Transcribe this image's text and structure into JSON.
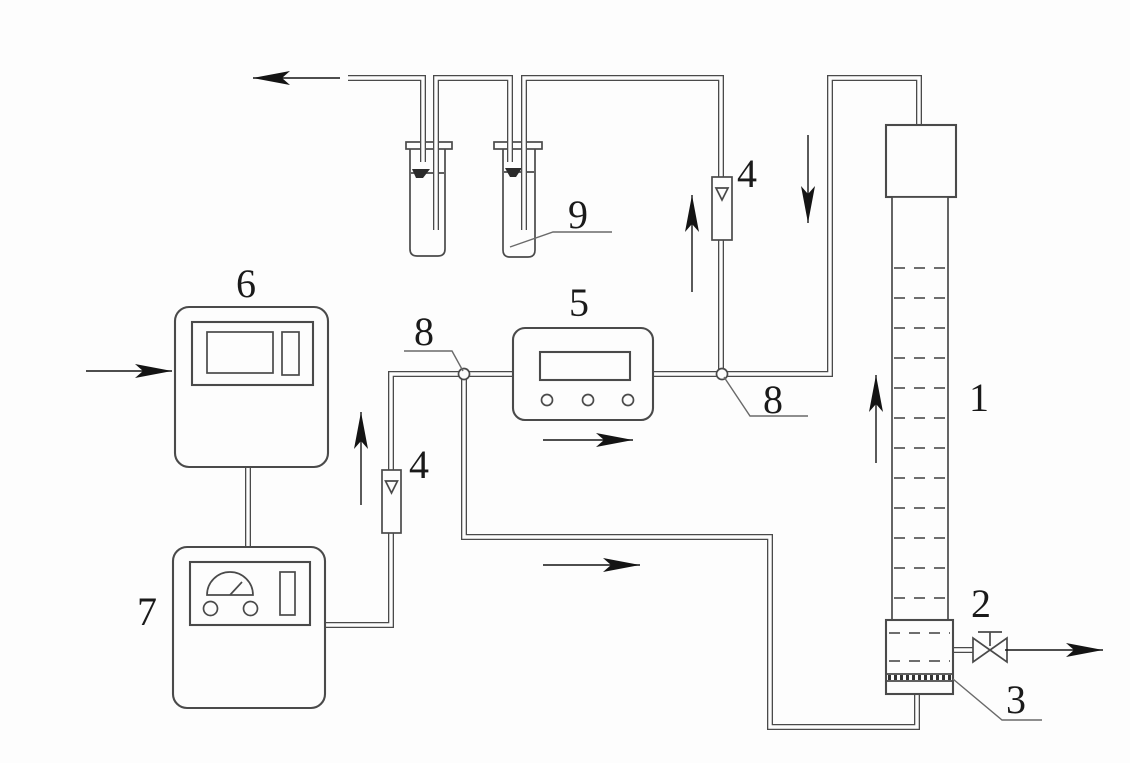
{
  "diagram": {
    "colors": {
      "background": "#fdfdfd",
      "line": "#4a4a4a",
      "arrow": "#141414",
      "text": "#1a1a1a"
    },
    "labels": {
      "column": "1",
      "column_base": "2",
      "distributor_plate": "3",
      "flowmeter_left": "4",
      "flowmeter_right": "4",
      "analyzer": "5",
      "instrument_top": "6",
      "instrument_bottom": "7",
      "junction_left": "8",
      "junction_right": "8",
      "sampling_bottles": "9"
    }
  }
}
